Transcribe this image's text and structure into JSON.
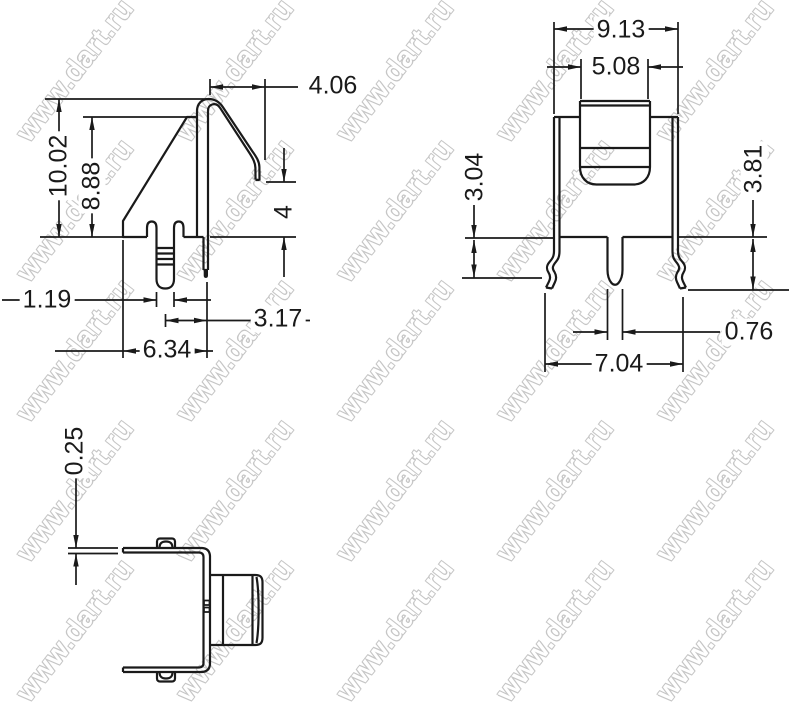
{
  "watermark": {
    "text": "www.dart.ru"
  },
  "drawing": {
    "line_color": "#1a1a1a",
    "side_view": {
      "dims": {
        "hook_overhang": "4.06",
        "overall_height": "10.02",
        "body_height": "8.88",
        "tip_to_base": "4",
        "pin_width": "1.19",
        "pin_to_back": "3.17",
        "base_width": "6.34"
      }
    },
    "front_view": {
      "dims": {
        "overall_width": "9.13",
        "tab_width": "5.08",
        "left_leg_drop": "3.04",
        "right_leg_drop": "3.81",
        "pin_thickness": "0.76",
        "leg_span": "7.04"
      }
    },
    "top_view": {
      "dims": {
        "material_thickness": "0.25"
      }
    }
  }
}
